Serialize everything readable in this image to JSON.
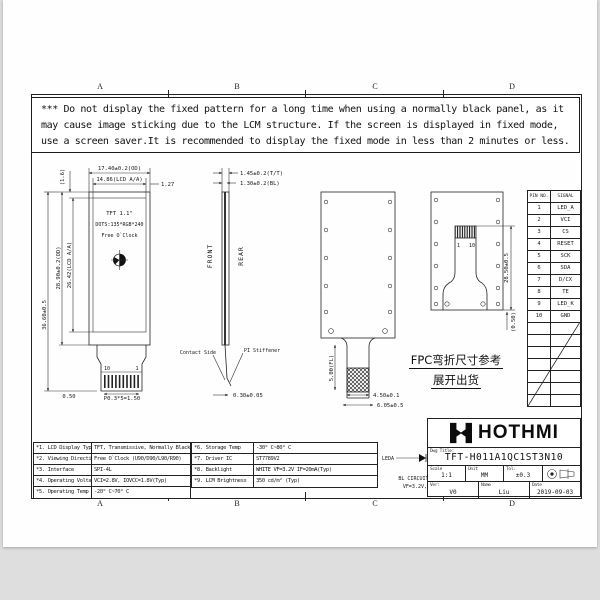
{
  "meta": {
    "bg": "#e3e3e3",
    "sheet": "#fefefe",
    "ink": "#1b1b1b"
  },
  "zones": {
    "letters": [
      "A",
      "B",
      "C",
      "D"
    ]
  },
  "warning": {
    "lines": [
      "*** Do not display the fixed pattern for a long time when using a normally black panel, as it",
      "may cause image sticking due to the LCM structure. If the screen is displayed in fixed mode,",
      "use a screen saver.It is recommended to display the fixed mode in less than 2 minutes or less."
    ]
  },
  "front": {
    "name": "TFT 1.1\"",
    "dots": "DOTS:135*RGB*240",
    "mode": "Free O`Clock",
    "pin_left": "10",
    "pin_right": "1",
    "dim_od_w": "17.40±0.2(OD)",
    "dim_aa_w": "14.86(LCD A/A)",
    "dim_gap_r": "1.27",
    "dim_gap_t": "(1.6)",
    "dim_od_h": "28.90±0.2(OD)",
    "dim_aa_h": "26.42(LCD A/A)",
    "dim_total": "36.60±0.5",
    "dim_pad": "0.50",
    "dim_pitch": "P0.3*5=1.50"
  },
  "side": {
    "front_label": "FRONT",
    "rear_label": "REAR",
    "dim_tt": "1.45±0.2(T/T)",
    "dim_bl": "1.30±0.2(BL)",
    "contact": "Contact Side",
    "stiffener": "PI Stiffener",
    "dim_tip": "0.30±0.05"
  },
  "rear_flat": {
    "dim_fl": "5.00(FL)",
    "dim_stiff_w": "4.50±0.1",
    "dim_end_w": "6.05±0.5"
  },
  "rear_bent": {
    "pin_a": "1",
    "pin_b": "10",
    "dim_len": "28.50±0.5",
    "dim_gap": "(0.50)"
  },
  "fpc_note": {
    "line1": "FPC弯折尺寸参考",
    "line2": "展开出货"
  },
  "pin_table": {
    "col1": "PIN NO.",
    "col2": "SIGNAL",
    "rows": [
      [
        "1",
        "LED_A"
      ],
      [
        "2",
        "VCI"
      ],
      [
        "3",
        "CS"
      ],
      [
        "4",
        "RESET"
      ],
      [
        "5",
        "SCK"
      ],
      [
        "6",
        "SDA"
      ],
      [
        "7",
        "D/CX"
      ],
      [
        "8",
        "TE"
      ],
      [
        "9",
        "LED_K"
      ],
      [
        "10",
        "GND"
      ]
    ]
  },
  "specs_left": [
    {
      "label": "*1. LCD Display Type",
      "value": "TFT, Transmissive, Normally Black"
    },
    {
      "label": "*2. Viewing Direction",
      "value": "Free O`Clock (U90/D90/L90/R90)"
    },
    {
      "label": "*3. Interface",
      "value": "SPI-4L"
    },
    {
      "label": "*4. Operating Voltage",
      "value": "VCI=2.8V, IOVCC=1.8V(Typ)"
    },
    {
      "label": "*5. Operating Temp",
      "value": "-20° C~70° C"
    }
  ],
  "specs_right": [
    {
      "label": "*6. Storage Temp",
      "value": "-30° C~80° C"
    },
    {
      "label": "*7. Driver IC",
      "value": "ST7789V2"
    },
    {
      "label": "*8. Backlight",
      "value": "WHITE VF=3.2V IF=20mA(Typ)"
    },
    {
      "label": "*9. LCM Brightness",
      "value": "350 cd/m² (Typ)"
    }
  ],
  "bl": {
    "leda": "LEDA",
    "ledk": "LEDK",
    "title": "BL CIRCUIT DIAGRAM:",
    "value": "VF=3.2V, IF=20mA"
  },
  "title_block": {
    "brand": "HOTHMI",
    "dwg_label": "Dwg Title:",
    "number": "TFT-H011A1QC1ST3N10",
    "scale_label": "Scale",
    "scale": "1:1",
    "unit_label": "Unit",
    "unit": "MM",
    "tol_label": "Tol.",
    "tol": "±0.3",
    "ver_label": "Ver:",
    "ver": "V0",
    "name_label": "Name",
    "name": "Liu",
    "date_label": "Date",
    "date": "2019-09-03"
  }
}
